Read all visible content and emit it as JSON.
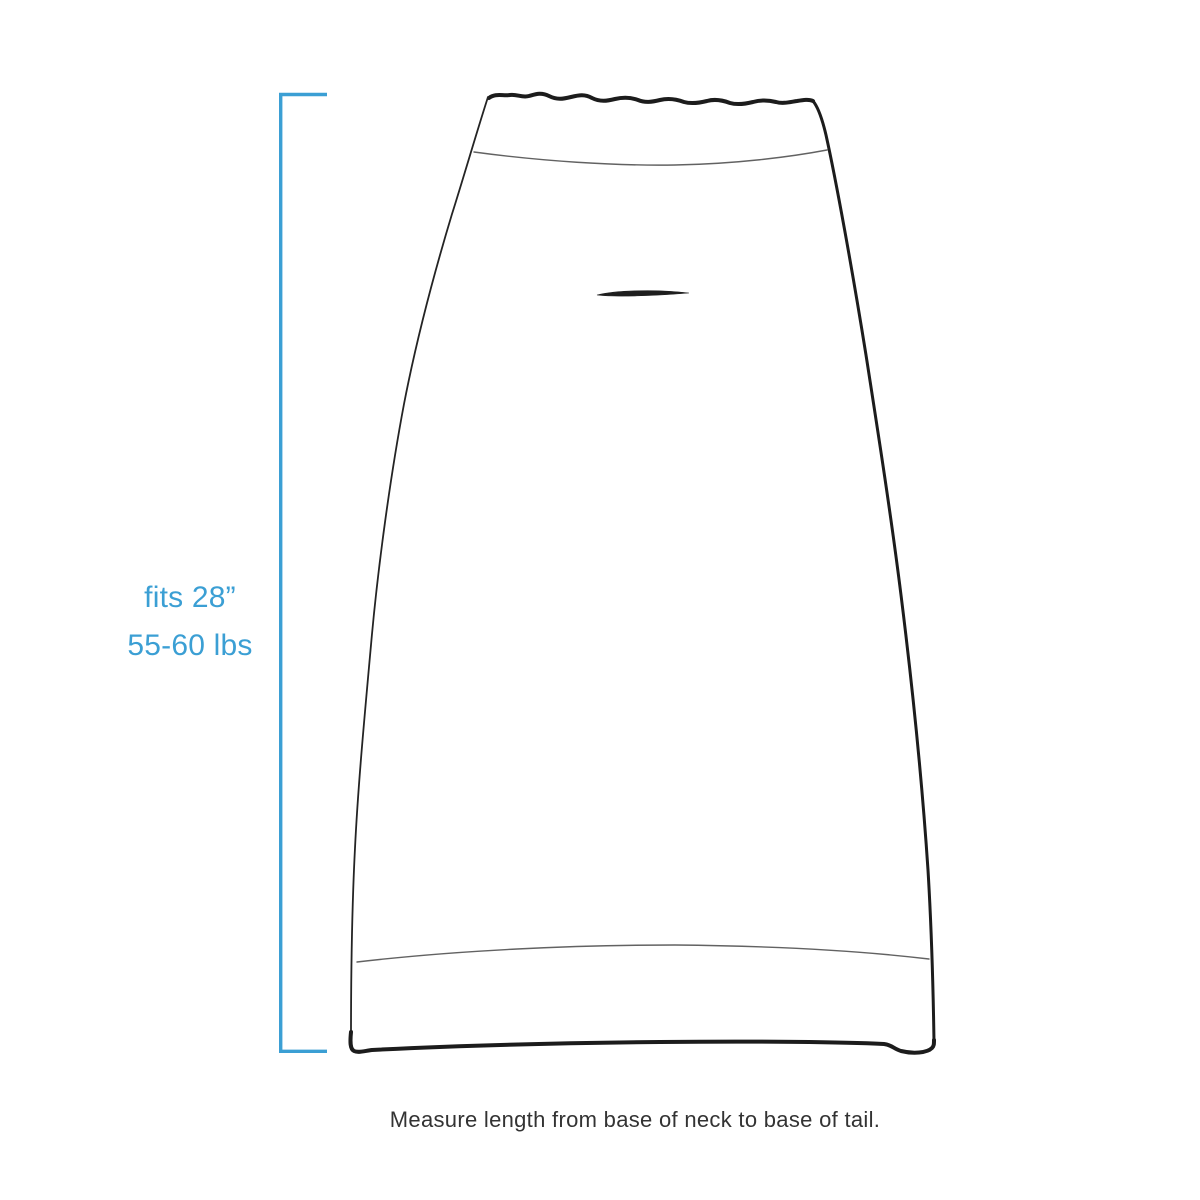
{
  "canvas": {
    "background": "#ffffff",
    "accent_color": "#3b9fd4",
    "ink_color": "#1c1c1c",
    "caption_color": "#333333",
    "illustration": "dog-garment-outline-drawing"
  },
  "measurement": {
    "fit_label": "fits 28”",
    "weight_label": "55-60 lbs"
  },
  "caption": {
    "text": "Measure length from base of neck to base of tail."
  }
}
